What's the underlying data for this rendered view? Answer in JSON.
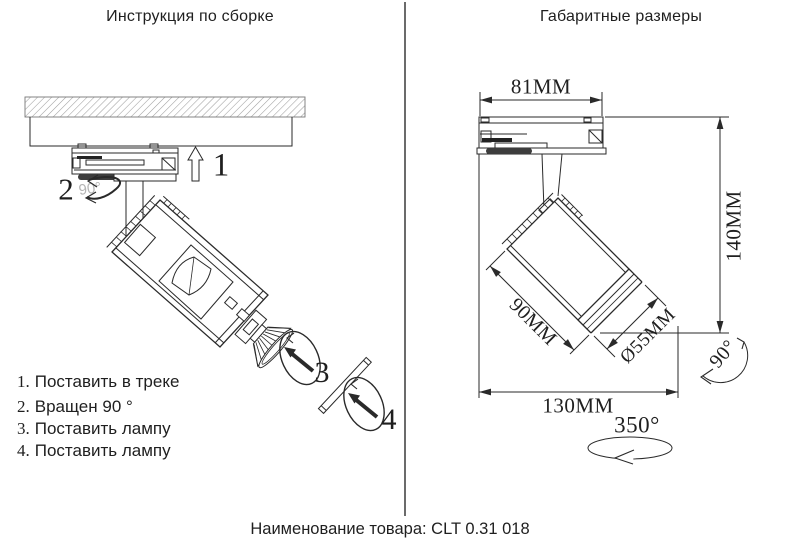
{
  "left_panel": {
    "title": "Инструкция по сборке",
    "steps": [
      {
        "num": "1.",
        "text": "Поставить в треке"
      },
      {
        "num": "2.",
        "text": "Вращен 90 °"
      },
      {
        "num": "3.",
        "text": "Поставить лампу"
      },
      {
        "num": "4.",
        "text": "Поставить лампу"
      }
    ],
    "markers": {
      "step1": "1",
      "step2": "2",
      "step3": "3",
      "step4": "4",
      "rotate_hint": "90°"
    }
  },
  "right_panel": {
    "title": "Габаритные размеры",
    "dimensions": {
      "adapter_width": "81MM",
      "overall_height": "140MM",
      "body_length": "90MM",
      "diameter": "Ø55MM",
      "overall_length": "130MM",
      "tilt_angle": "90°",
      "rotation_angle": "350°"
    }
  },
  "footer": {
    "product_label": "Наименование товара: CLT 0.31 018"
  },
  "colors": {
    "line": "#2a2a2a",
    "muted": "#b5b5b5",
    "background": "#ffffff"
  }
}
